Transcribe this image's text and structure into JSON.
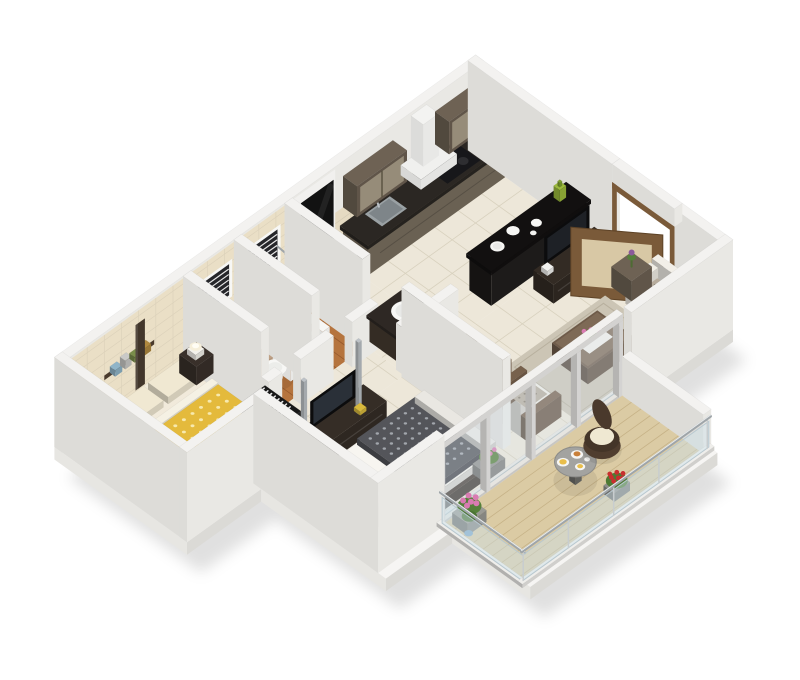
{
  "image_type": "3d-isometric-floor-plan-render",
  "palette": {
    "bg": "#FFFFFF",
    "wall": "#F3F2F0",
    "wall_side": "#E9E8E4",
    "wall_west": "#DDDCD8",
    "slab_top": "#F6F5F3",
    "slab_front": "#DBDAD6",
    "slab_west": "#E7E6E2",
    "floor_tile": "#EDE7D9",
    "tile_line": "#D8D1BE",
    "wood_floor": "#B5743E",
    "wood_line": "#96592C",
    "bath_wall_tile": "#EADFC6",
    "backsplash": "#E5DAC2",
    "balcony_floor": "#DBCBA4",
    "balcony_line": "#C6B287",
    "gold_quilt": "#E4BA3C",
    "gold_dot": "#F7E9AE",
    "cream": "#F0E8D2",
    "dark_wood": "#352D26",
    "dark_wood2": "#4A4038",
    "steel": "#BDC2C7",
    "black_panel": "#121212",
    "tv_black": "#0C0C0D",
    "kitchen_cabinet": "#7A6F5F",
    "counter_dark": "#2B2723",
    "wall_cabinet": "#6E6254",
    "bar_black": "#1B1917",
    "appliance_white": "#F2F2F1",
    "sofa_white": "#F0EDE5",
    "cushion_floral": "#B7AC9C",
    "cushion_dot": "#847A6B",
    "rug": "#CCC5B5",
    "wood_mid": "#77614C",
    "door_brown": "#7A5A39",
    "door_panel": "#D8C8A5",
    "glass": "rgba(206,226,236,0.45)",
    "rail_steel": "#9FA5A9",
    "leaf_green": "#55803A",
    "flower_pink": "#D97BB2",
    "flower_red": "#C92F2F",
    "food_yellow": "#E9BE4A",
    "lamp_warm": "#F6EFDA",
    "quilt_dark": "#54555A",
    "quilt_dot": "#A2A6AC",
    "hatch_dark": "#1B1B1B",
    "white_fixture": "#F7F7F5"
  },
  "structure": [
    {
      "id": "shadow",
      "label": "soft drop shadow under model"
    },
    {
      "id": "slab",
      "label": "building floor slab"
    },
    {
      "id": "north-wall",
      "label": "back exterior wall"
    },
    {
      "id": "west-wall",
      "label": "west exterior wall"
    },
    {
      "id": "east-wall",
      "label": "east exterior wall with entrance opening"
    },
    {
      "id": "wall-divider-1",
      "label": "wall bedroom / bathroom 1"
    },
    {
      "id": "wall-divider-2",
      "label": "wall bathroom 1 / bathroom 2"
    },
    {
      "id": "wall-divider-3",
      "label": "wall bathroom 2 / utility"
    },
    {
      "id": "bath-front-walls",
      "label": "cutaway bathroom front walls"
    },
    {
      "id": "bedroom1-south-wall",
      "label": "master bedroom south wall"
    },
    {
      "id": "wall-bedroom2-living",
      "label": "wall bedroom 2 / living room"
    },
    {
      "id": "living-south-wall",
      "label": "living room south wall"
    },
    {
      "id": "bedroom2-west-wall",
      "label": "bedroom 2 west wall"
    },
    {
      "id": "bedroom2-south-wall",
      "label": "bedroom 2 south wall"
    },
    {
      "id": "balcony-east-wall",
      "label": "balcony parapet east"
    },
    {
      "id": "sliding-glass-doors",
      "label": "sliding glass doors to balcony"
    },
    {
      "id": "railing-west",
      "label": "balcony glass railing west"
    },
    {
      "id": "railing-south",
      "label": "balcony glass railing south"
    }
  ],
  "rooms": [
    {
      "id": "master-bedroom",
      "label": "master bedroom",
      "floor": "floor-master-bedroom",
      "furniture": [
        {
          "id": "bed-master",
          "label": "double bed with gold floral quilt",
          "color": "#E4BA3C"
        },
        {
          "id": "bedside-master-west",
          "label": "bedside table with lamp (west)",
          "color": "#39302A"
        },
        {
          "id": "bedside-master-east",
          "label": "bedside table with lamp (east)",
          "color": "#39302A"
        },
        {
          "id": "wall-shelf",
          "label": "wall shelf with decor and panel",
          "color": "#4A3A2C"
        },
        {
          "id": "wardrobe-master",
          "label": "built-in wardrobe (section hatch)",
          "color": "#1B1B1B"
        }
      ]
    },
    {
      "id": "bathroom-1",
      "label": "attached bathroom",
      "floor": "floor-bathroom-1",
      "furniture": [
        {
          "id": "shower-glass",
          "label": "glass shower partition"
        },
        {
          "id": "washbasin-bath1",
          "label": "counter washbasin",
          "color": "#F7F7F5"
        },
        {
          "id": "toilet-bath1",
          "label": "toilet",
          "color": "#F7F7F5"
        },
        {
          "id": "bathroom-window-1",
          "label": "window with blinds"
        }
      ]
    },
    {
      "id": "bathroom-2",
      "label": "common bathroom",
      "floor": "floor-bathroom-2",
      "furniture": [
        {
          "id": "toilet-bath2",
          "label": "toilet",
          "color": "#F7F7F5"
        },
        {
          "id": "shower-head-bath2",
          "label": "shower head"
        },
        {
          "id": "bathroom-window-2",
          "label": "window with blinds"
        }
      ]
    },
    {
      "id": "utility-passage",
      "label": "utility passage",
      "floor": "floor-utility",
      "furniture": [
        {
          "id": "washing-machine",
          "label": "front-load washing machine",
          "color": "#F2F2F1"
        },
        {
          "id": "black-wall-panel",
          "label": "black wall panel",
          "color": "#121212"
        },
        {
          "id": "vanity-washbasin",
          "label": "vanity with oval washbasin",
          "color": "#463B31"
        },
        {
          "id": "utility-ledge",
          "label": "low ledge wall"
        }
      ]
    },
    {
      "id": "kitchen",
      "label": "kitchen",
      "floor": "floor-kitchen",
      "furniture": [
        {
          "id": "kitchen-counter",
          "label": "base cabinets with dark counter",
          "color": "#7A6F5F"
        },
        {
          "id": "kitchen-sink",
          "label": "stainless sink"
        },
        {
          "id": "kitchen-hob",
          "label": "hob with pan"
        },
        {
          "id": "wall-cabinet-1",
          "label": "glass wall cabinet",
          "color": "#6E6254"
        },
        {
          "id": "chimney-hood",
          "label": "chimney hood",
          "color": "#F0F0EE"
        },
        {
          "id": "wall-cabinet-2",
          "label": "glass wall cabinet",
          "color": "#6E6254"
        },
        {
          "id": "breakfast-bar",
          "label": "black breakfast bar with plates",
          "color": "#1B1917"
        }
      ]
    },
    {
      "id": "bedroom-2",
      "label": "second bedroom",
      "floor": "floor-bedroom-2",
      "furniture": [
        {
          "id": "tv-unit-bedroom2",
          "label": "TV unit with steel posts",
          "color": "#352D26"
        },
        {
          "id": "bed-dark",
          "label": "double bed with dark patterned quilt",
          "color": "#54555A"
        },
        {
          "id": "bedside-bedroom2",
          "label": "bedside table with lamp",
          "color": "#39302A"
        },
        {
          "id": "pedestal-lamp",
          "label": "white pedestal lamp"
        },
        {
          "id": "window-planter",
          "label": "planter with pink roses",
          "color": "#D97BB2"
        },
        {
          "id": "wardrobe-bedroom2",
          "label": "wardrobe (section hatch)",
          "color": "#1B1B1B"
        }
      ]
    },
    {
      "id": "living-room",
      "label": "living room",
      "floor": "floor-living-room",
      "furniture": [
        {
          "id": "tv-cabinet-living",
          "label": "TV cabinet with flat TV",
          "color": "#332B24"
        },
        {
          "id": "entrance-door-frame",
          "label": "entrance door frame",
          "color": "#7A5A39"
        },
        {
          "id": "entrance-door",
          "label": "open entrance door",
          "color": "#7A5A39"
        },
        {
          "id": "sofa",
          "label": "white sofa with floral cushions",
          "color": "#F0EDE5"
        },
        {
          "id": "side-table",
          "label": "side table with plant"
        },
        {
          "id": "rug",
          "label": "area rug",
          "color": "#CCC5B5"
        },
        {
          "id": "coffee-table",
          "label": "coffee table with flowers",
          "color": "#6F5B49"
        },
        {
          "id": "armchair-1",
          "label": "armchair with floral cushion"
        },
        {
          "id": "armchair-2",
          "label": "armchair with floral cushion"
        }
      ]
    },
    {
      "id": "balcony",
      "label": "balcony",
      "floor": "floor-balcony",
      "furniture": [
        {
          "id": "planter-pink",
          "label": "planter with pink flowers",
          "color": "#D97BB2"
        },
        {
          "id": "balcony-table",
          "label": "round table with breakfast plates"
        },
        {
          "id": "wicker-chair",
          "label": "wicker chair with cream cushion",
          "color": "#4A392C"
        },
        {
          "id": "planter-red",
          "label": "planter with red flowers",
          "color": "#C92F2F"
        }
      ]
    }
  ]
}
